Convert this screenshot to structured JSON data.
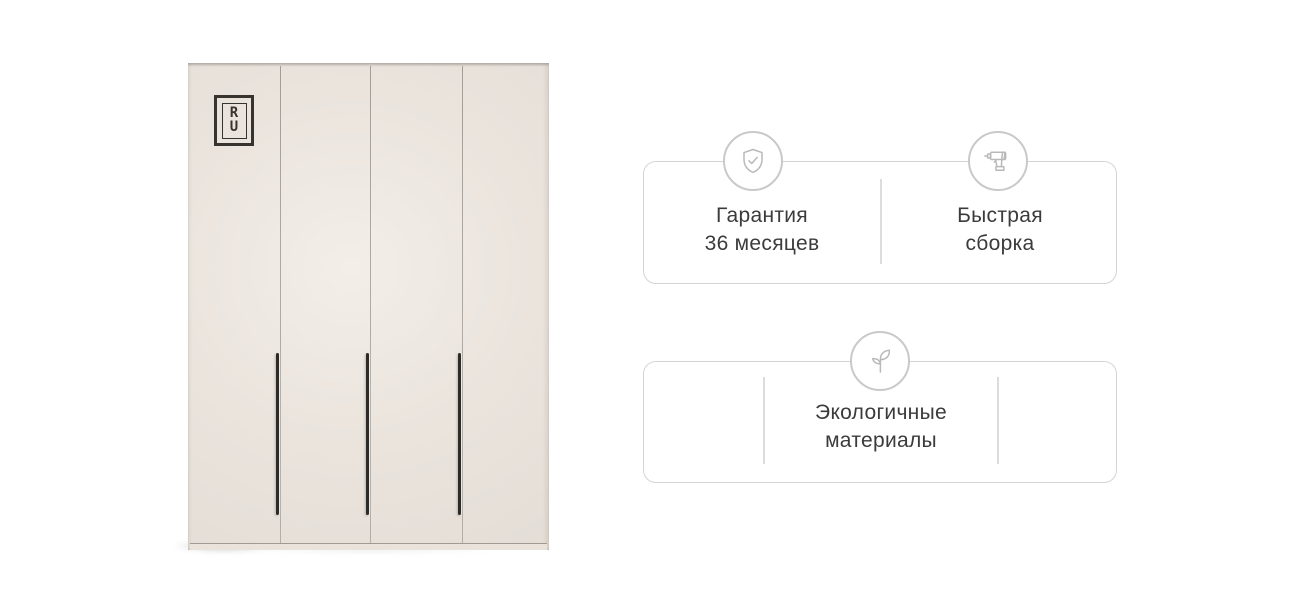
{
  "wardrobe": {
    "description": "four-door beige wardrobe with vertical black handles",
    "door_count": 4,
    "logo": {
      "letter_top": "R",
      "letter_bottom": "U"
    },
    "colors": {
      "body": "#e8e2db",
      "highlight": "#f3eee8",
      "seam": "#69635c",
      "handle": "#2d2b28",
      "plinth": "#e9e3dc",
      "logo": "#37332e"
    }
  },
  "feature_cards": [
    {
      "items": [
        {
          "icon": "shield-check-icon",
          "line1": "Гарантия",
          "line2": "36 месяцев"
        },
        {
          "icon": "drill-icon",
          "line1": "Быстрая",
          "line2": "сборка"
        }
      ]
    },
    {
      "items": [
        {
          "icon": "leaf-icon",
          "line1": "Экологичные",
          "line2": "материалы"
        }
      ]
    }
  ],
  "ui_colors": {
    "background": "#ffffff",
    "card_border": "#d4d4d4",
    "circle_border": "#c9c9c9",
    "icon_stroke": "#b9b9b9",
    "divider": "#dcdcdc",
    "text": "#3b3b3b"
  }
}
